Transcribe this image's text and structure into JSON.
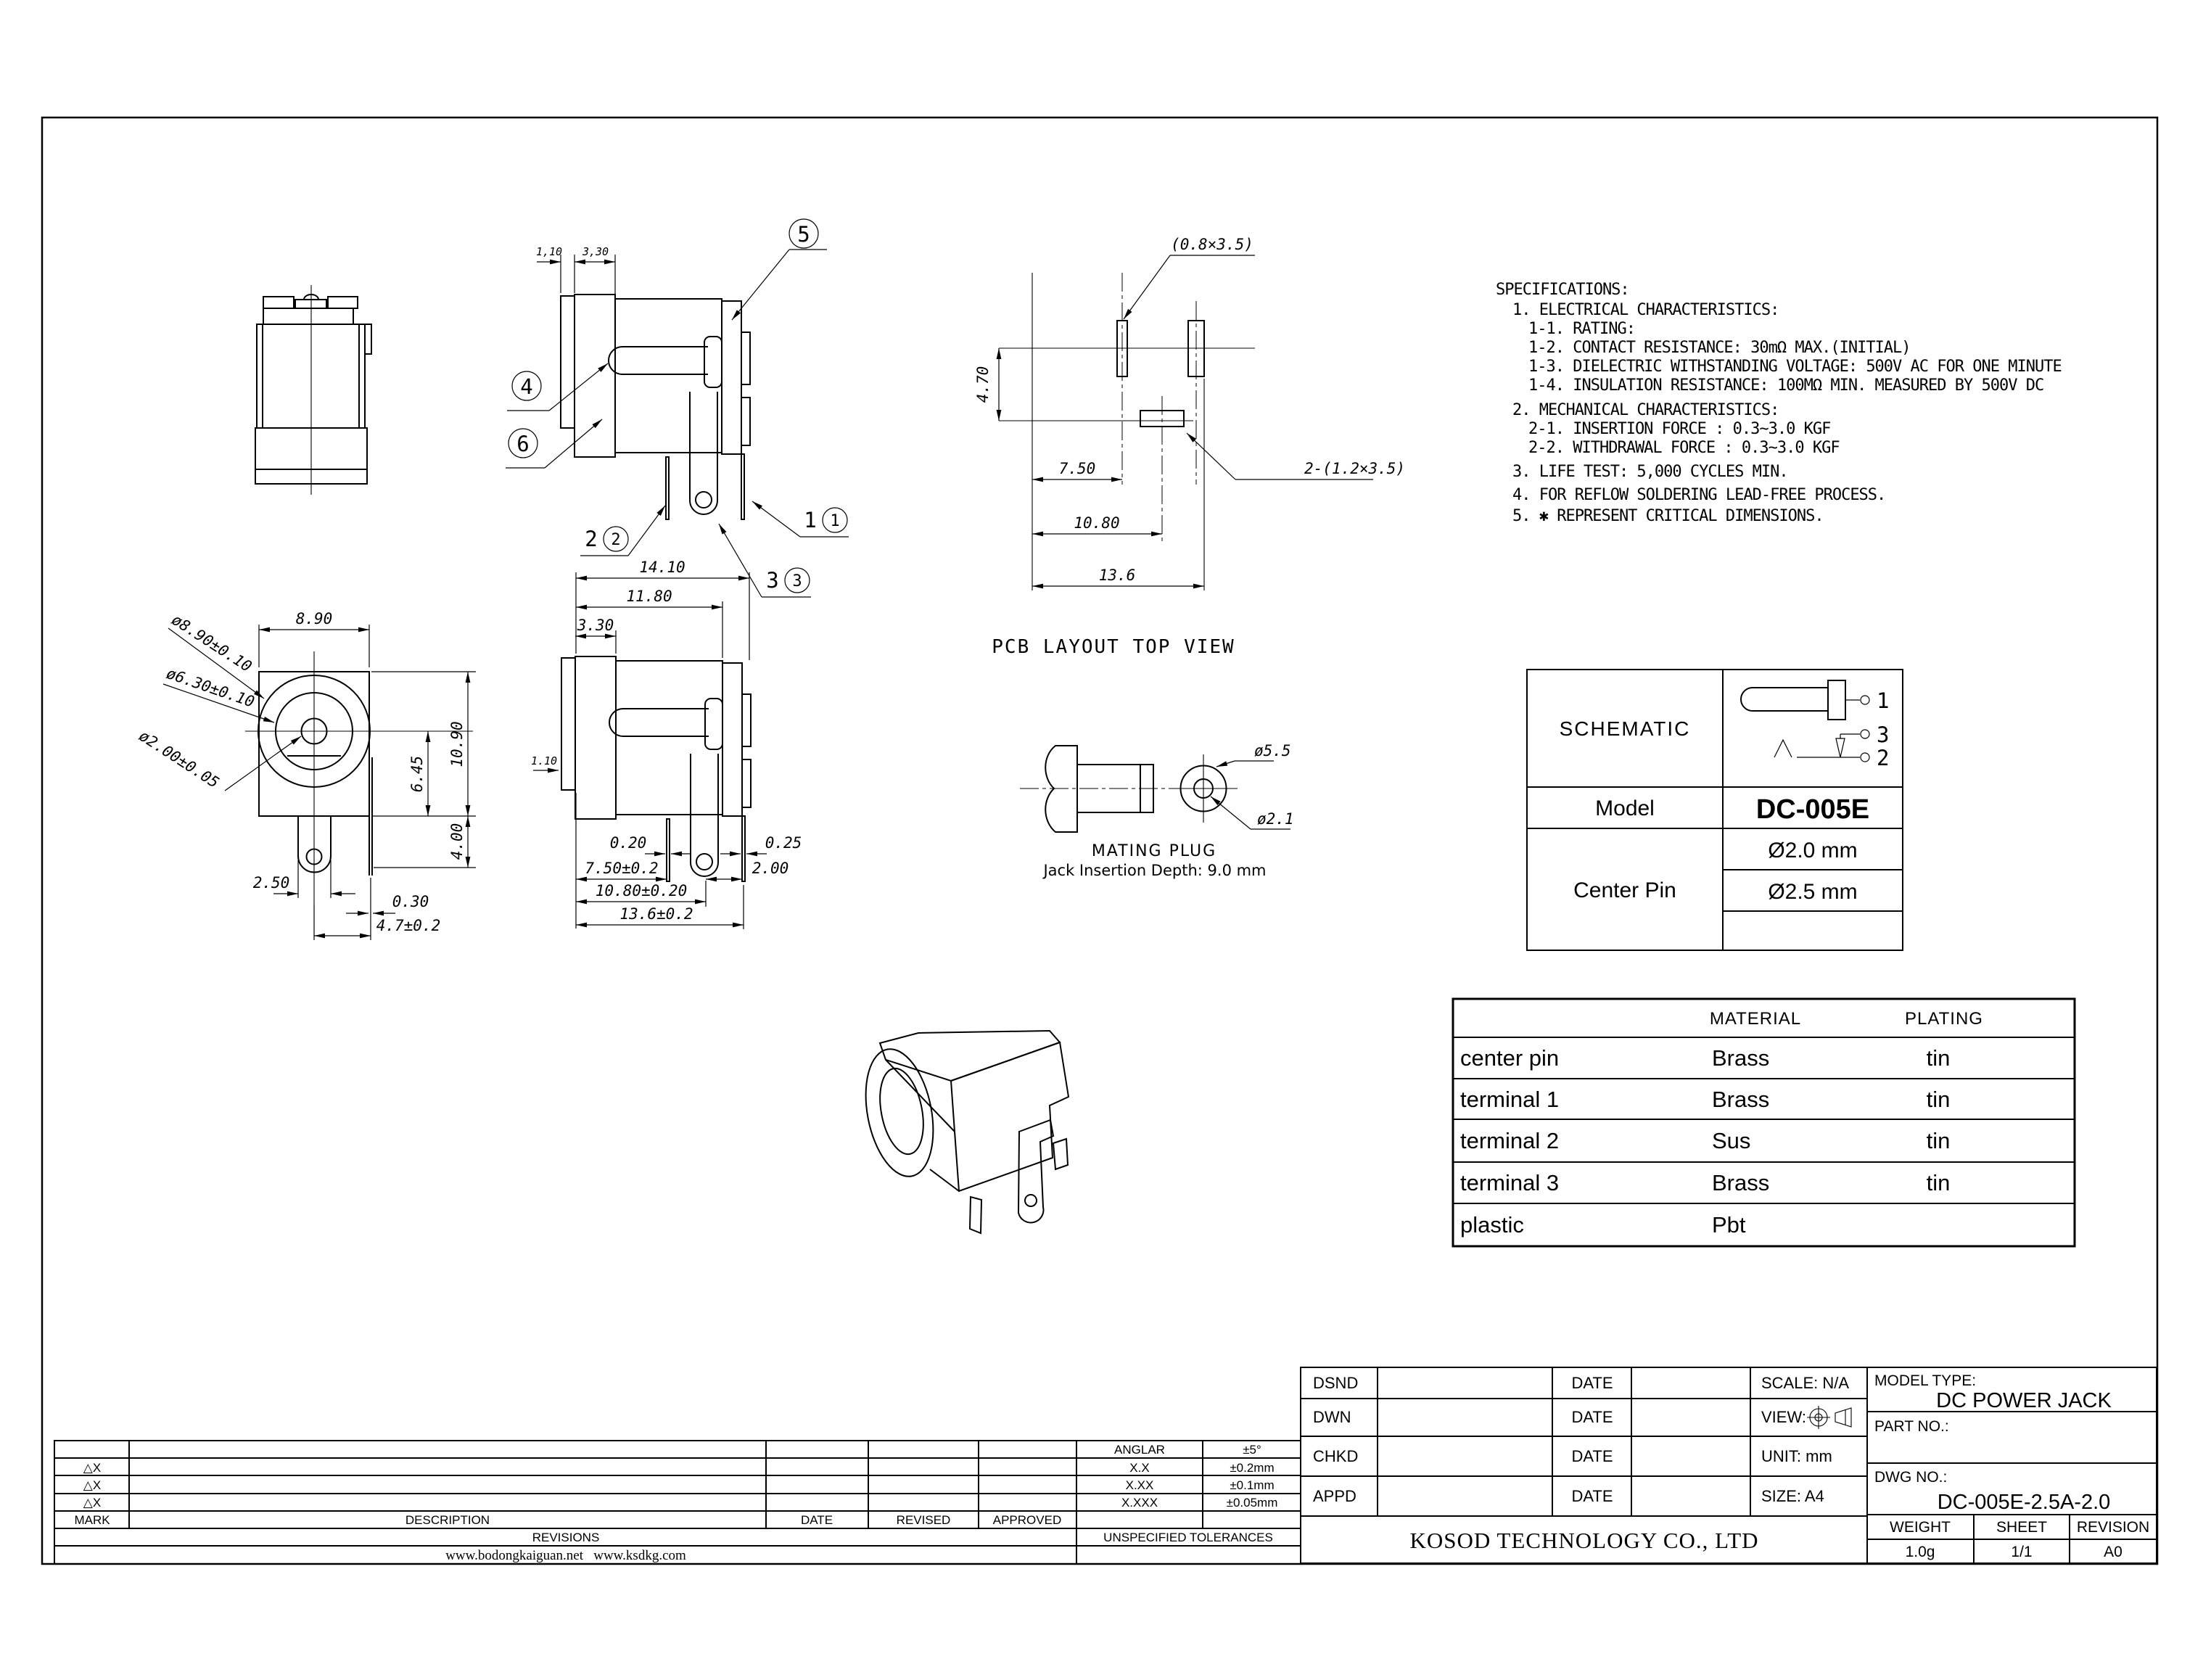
{
  "page": {
    "background": "#ffffff",
    "line_color": "#000000"
  },
  "specs": {
    "lines": [
      "SPECIFICATIONS:",
      "1. ELECTRICAL CHARACTERISTICS:",
      "1-1. RATING:",
      "1-2. CONTACT RESISTANCE: 30mΩ MAX.(INITIAL)",
      "1-3. DIELECTRIC WITHSTANDING VOLTAGE: 500V AC FOR ONE MINUTE",
      "1-4. INSULATION RESISTANCE: 100MΩ MIN. MEASURED BY 500V DC",
      "2. MECHANICAL CHARACTERISTICS:",
      "2-1. INSERTION FORCE : 0.3~3.0 KGF",
      "2-2. WITHDRAWAL FORCE : 0.3~3.0 KGF",
      "3. LIFE TEST: 5,000 CYCLES MIN.",
      "4. FOR REFLOW SOLDERING LEAD-FREE PROCESS.",
      "5. ✱ REPRESENT CRITICAL DIMENSIONS."
    ]
  },
  "callouts": {
    "c1": "1",
    "c2": "2",
    "c3": "3",
    "c4": "4",
    "c5": "5",
    "c6": "6"
  },
  "views": {
    "side_top": {
      "dims": {
        "flange": "1,10",
        "body": "3,30"
      }
    },
    "pcb": {
      "caption": "PCB LAYOUT TOP VIEW",
      "slot_small": "(0.8×3.5)",
      "slot_center": "2-(1.2×3.5)",
      "dims": {
        "v": "4.70",
        "x1": "7.50",
        "x2": "10.80",
        "x3": "13.6"
      }
    },
    "front": {
      "dims": {
        "width": "8.90",
        "d_outer": "ø8.90±0.10",
        "d_mid": "ø6.30±0.10",
        "d_pin": "ø2.00±0.05",
        "height": "10.90",
        "h_center": "6.45",
        "h_lug": "4.00",
        "lug_w": "2.50",
        "leg_t": "0.30",
        "leg_off": "4.7±0.2"
      }
    },
    "side": {
      "dims": {
        "overall": "14.10",
        "body": "11.80",
        "front": "3.30",
        "flange": "1.10",
        "leg1_t": "0.20",
        "leg1_x": "7.50±0.2",
        "bracket_x": "10.80±0.20",
        "overall_x": "13.6±0.2",
        "leg2_t": "0.25",
        "leg2_gap": "2.00"
      }
    },
    "plug": {
      "d_outer": "ø5.5",
      "d_inner": "ø2.1",
      "caption": "MATING PLUG",
      "note": "Jack Insertion Depth: 9.0 mm"
    }
  },
  "schematic_table": {
    "header": "SCHEMATIC",
    "model_label": "Model",
    "model_value": "DC-005E",
    "center_pin_label": "Center Pin",
    "pin_d1": "Ø2.0 mm",
    "pin_d2": "Ø2.5 mm",
    "pins": {
      "p1": "1",
      "p2": "2",
      "p3": "3"
    }
  },
  "material_table": {
    "col_material": "MATERIAL",
    "col_plating": "PLATING",
    "rows": [
      [
        "center pin",
        "Brass",
        "tin"
      ],
      [
        "terminal 1",
        "Brass",
        "tin"
      ],
      [
        "terminal 2",
        "Sus",
        "tin"
      ],
      [
        "terminal 3",
        "Brass",
        "tin"
      ],
      [
        "plastic",
        "Pbt",
        ""
      ]
    ]
  },
  "revisions": {
    "mark": "△X",
    "anglar_label": "ANGLAR",
    "anglar_value": "±5°",
    "tols": [
      [
        "X.X",
        "±0.2mm"
      ],
      [
        "X.XX",
        "±0.1mm"
      ],
      [
        "X.XXX",
        "±0.05mm"
      ]
    ],
    "headers": [
      "MARK",
      "DESCRIPTION",
      "DATE",
      "REVISED",
      "APPROVED"
    ],
    "revisions_label": "REVISIONS",
    "unspecified_label": "UNSPECIFIED TOLERANCES",
    "websites": "www.bodongkaiguan.net   www.ksdkg.com"
  },
  "title_block": {
    "dsnd": "DSND",
    "dwn": "DWN",
    "chkd": "CHKD",
    "appd": "APPD",
    "date": "DATE",
    "scale": "SCALE: N/A",
    "view": "VIEW:",
    "unit": "UNIT: mm",
    "size": "SIZE: A4",
    "company": "KOSOD TECHNOLOGY CO., LTD",
    "model_type_label": "MODEL TYPE:",
    "model_type": "DC POWER JACK",
    "part_no_label": "PART NO.:",
    "dwg_no_label": "DWG NO.:",
    "dwg_no": "DC-005E-2.5A-2.0",
    "weight_label": "WEIGHT",
    "sheet_label": "SHEET",
    "revision_label": "REVISION",
    "weight": "1.0g",
    "sheet": "1/1",
    "revision": "A0"
  }
}
